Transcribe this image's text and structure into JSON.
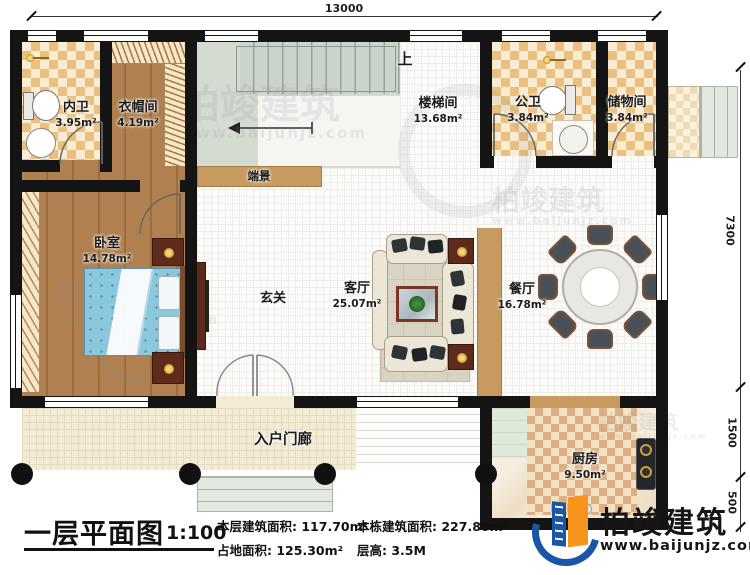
{
  "plan": {
    "title": "一层平面图",
    "scale": "1:100",
    "stats": {
      "floor_area_label": "本层建筑面积:",
      "floor_area_value": "117.70m²",
      "land_area_label": "占地面积:",
      "land_area_value": "125.30m²",
      "total_area_label": "本栋建筑面积:",
      "total_area_value": "227.80m²",
      "height_label": "层高:",
      "height_value": "3.5M"
    }
  },
  "dimensions": {
    "total_width": "13000",
    "main_depth": "7300",
    "porch_depth": "1500",
    "steps_depth": "500"
  },
  "rooms": {
    "inner_bath": {
      "name": "内卫",
      "area": "3.95m²"
    },
    "cloakroom": {
      "name": "衣帽间",
      "area": "4.19m²"
    },
    "stairwell": {
      "name": "楼梯间",
      "area": "13.68m²"
    },
    "public_bath": {
      "name": "公卫",
      "area": "3.84m²"
    },
    "storage": {
      "name": "储物间",
      "area": "3.84m²"
    },
    "bedroom": {
      "name": "卧室",
      "area": "14.78m²"
    },
    "foyer": {
      "name": "玄关"
    },
    "living": {
      "name": "客厅",
      "area": "25.07m²"
    },
    "dining": {
      "name": "餐厅",
      "area": "16.78m²"
    },
    "kitchen": {
      "name": "厨房",
      "area": "9.50m²"
    },
    "entry_porch": {
      "name": "入户门廊"
    },
    "console": {
      "name": "端景"
    },
    "stairs_up": "上"
  },
  "brand": {
    "name": "柏竣建筑",
    "site": "www.baijunjz.com",
    "blue": "#1a56a8",
    "orange": "#f7941d"
  },
  "watermark": {
    "name": "柏竣建筑",
    "site": "www.baijunjz.com"
  }
}
